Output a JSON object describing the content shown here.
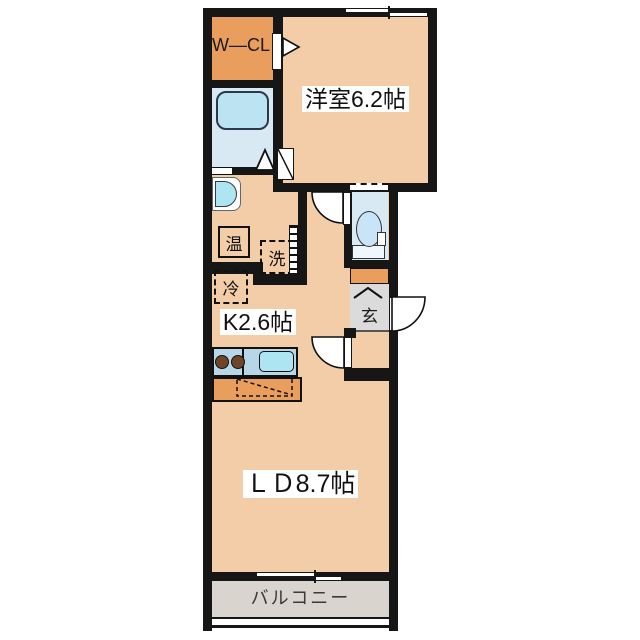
{
  "floor_plan": {
    "type": "apartment-1LDK-floor-plan",
    "rooms": {
      "western_room": {
        "label": "洋室6.2帖"
      },
      "kitchen": {
        "label": "K2.6帖"
      },
      "living_dining": {
        "label": "ＬＤ8.7帖"
      },
      "balcony": {
        "label": "バルコニー"
      },
      "walk_in_closet": {
        "label": "W―CL"
      },
      "entrance": {
        "label": "玄"
      },
      "water_heater": {
        "label": "温"
      },
      "washing_machine": {
        "label": "洗"
      },
      "refrigerator": {
        "label": "冷"
      }
    },
    "colors": {
      "floor": "#F2CDA7",
      "accent_orange": "#EA9E5D",
      "wet_blue": "#D9E9F4",
      "fixture_blue": "#BCE3F1",
      "counter_blue": "#B7D7E9",
      "sink_blue": "#ADE5F3",
      "genkan_gray": "#DBDBDB",
      "balcony_gray": "#D9D4CD",
      "wall": "#161616",
      "burner_brown": "#6F4528"
    }
  }
}
